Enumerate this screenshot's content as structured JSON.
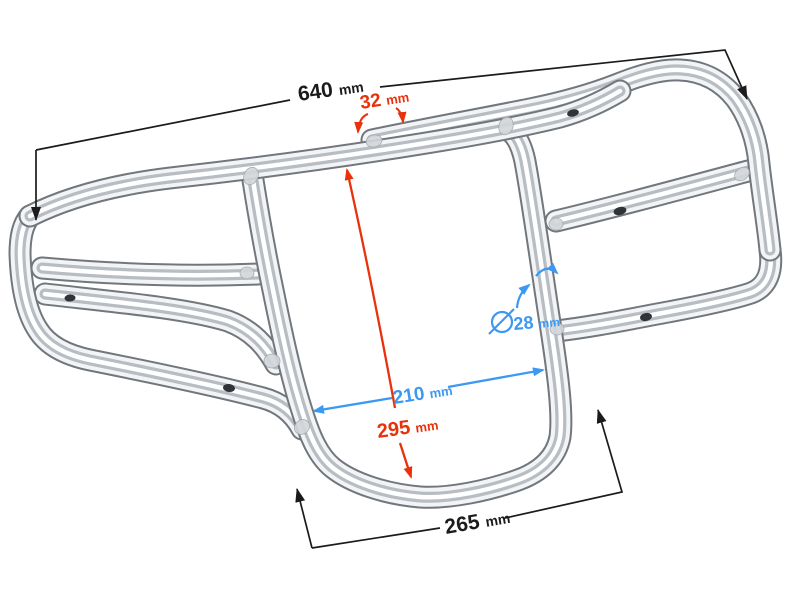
{
  "image": {
    "description": "Chrome tubular luggage rack / bumper product photo with dimension callouts",
    "background_color": "#ffffff"
  },
  "dimensions": {
    "total_width": {
      "value": "640",
      "unit": "mm",
      "color": "#1b1b1b"
    },
    "top_tube_offset": {
      "value": "32",
      "unit": "mm",
      "color": "#e8320c"
    },
    "inner_height": {
      "value": "295",
      "unit": "mm",
      "color": "#e8320c"
    },
    "inner_width": {
      "value": "210",
      "unit": "mm",
      "color": "#3b99f3"
    },
    "tube_diameter": {
      "value": "28",
      "unit": "mm",
      "symbol": "Ø",
      "color": "#3b99f3"
    },
    "bottom_width": {
      "value": "265",
      "unit": "mm",
      "color": "#1b1b1b"
    }
  }
}
